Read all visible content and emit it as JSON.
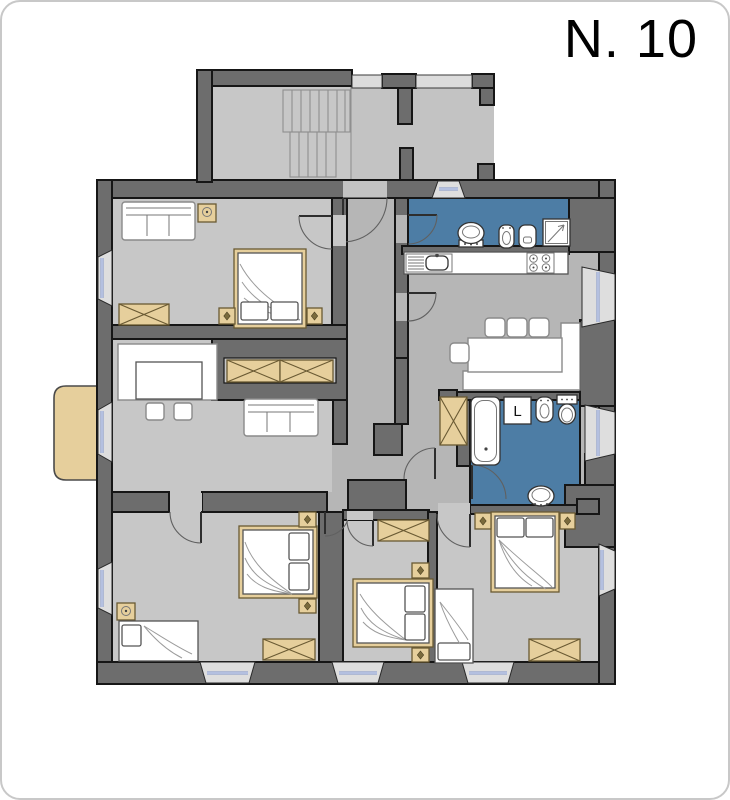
{
  "title": "N. 10",
  "bathroom": {
    "washing_machine_label": "L"
  },
  "colors": {
    "wall": "#6d6d6d",
    "outline": "#161616",
    "room_floor": "#c7c7c7",
    "hall_floor": "#b6b6b6",
    "landing_floor": "#c3c3c3",
    "bathroom_floor": "#4d7da5",
    "wood_furniture": "#e6cf9c",
    "window_glass": "#8094c8",
    "white_furniture": "#ffffff",
    "page_background": "#ffffff"
  },
  "inventory": {
    "rooms": [
      "stairwell",
      "landing",
      "hallway",
      "bedroom-top-left",
      "living-room",
      "kitchen-dining",
      "bathroom-top",
      "bathroom-middle",
      "bedroom-bottom-left",
      "bedroom-bottom-middle",
      "bedroom-bottom-right",
      "balcony"
    ],
    "furniture_icons": [
      "double-bed",
      "single-bed",
      "sofa",
      "wardrobe",
      "nightstand",
      "lamp-table",
      "dining-table",
      "chair",
      "bench",
      "kitchen-counter",
      "kitchen-sink",
      "stove",
      "wash-basin",
      "bidet",
      "toilet",
      "shower",
      "bathtub",
      "washing-machine",
      "stairs",
      "window",
      "door"
    ]
  }
}
